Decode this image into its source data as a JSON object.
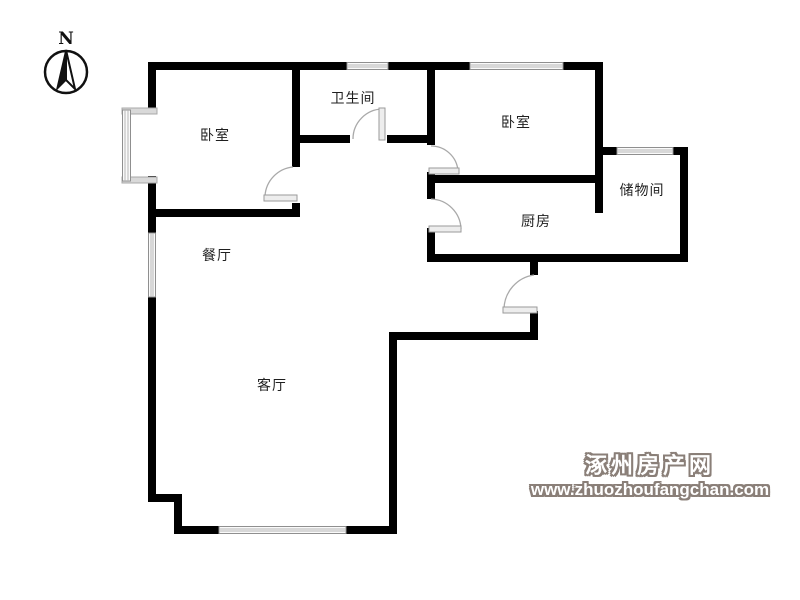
{
  "compass": {
    "north_label": "N"
  },
  "rooms": [
    {
      "id": "bedroom-1",
      "label": "卧室"
    },
    {
      "id": "bathroom",
      "label": "卫生间"
    },
    {
      "id": "bedroom-2",
      "label": "卧室"
    },
    {
      "id": "storage",
      "label": "储物间"
    },
    {
      "id": "kitchen",
      "label": "厨房"
    },
    {
      "id": "dining",
      "label": "餐厅"
    },
    {
      "id": "living",
      "label": "客厅"
    }
  ],
  "watermark": {
    "site_name": "涿州房产网",
    "site_url": "www.zhuozhoufangchan.com"
  },
  "colors": {
    "wall": "#000000",
    "door_arc": "#a9a9a9",
    "window_line": "#b5b5b5",
    "label_text": "#1f1f1f",
    "watermark_outline": "#8a7f78",
    "watermark_fill": "#ffffff",
    "background": "#ffffff"
  }
}
